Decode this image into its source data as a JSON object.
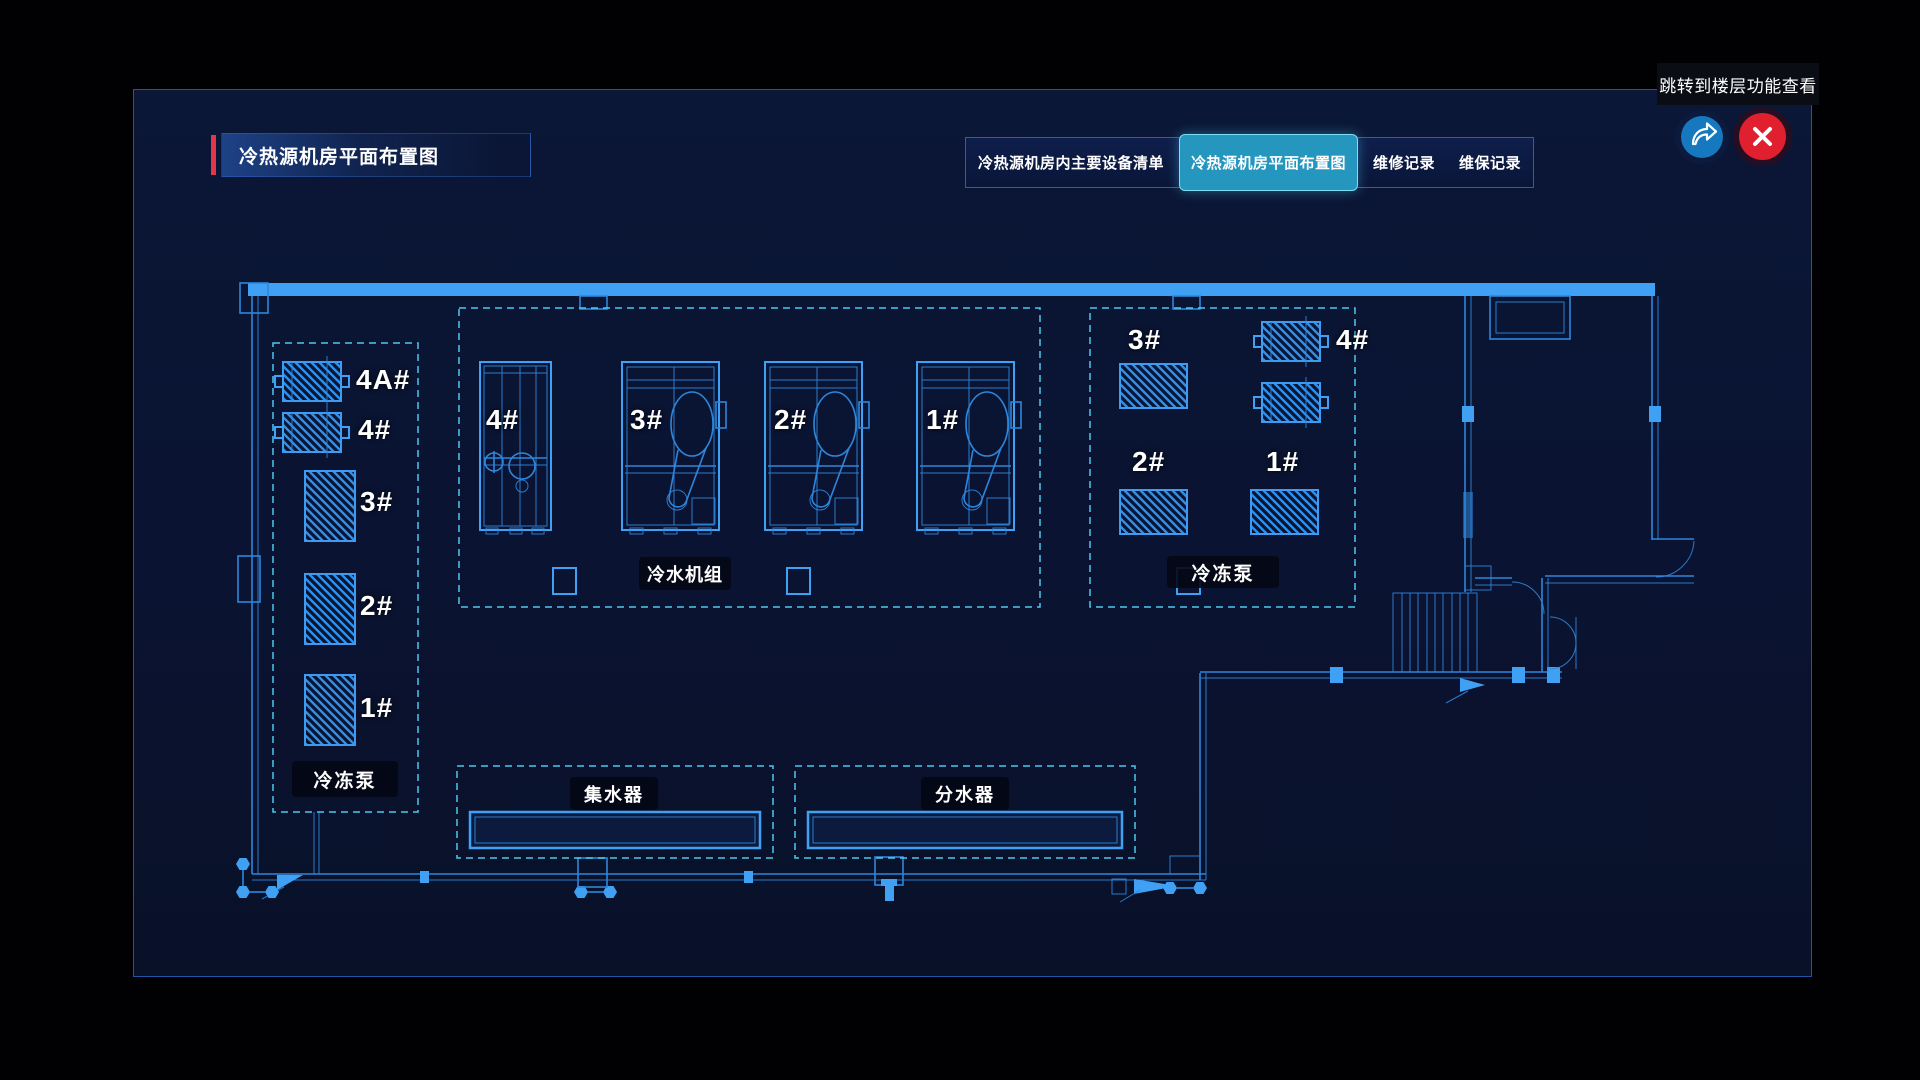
{
  "window": {
    "tooltip": "跳转到楼层功能查看",
    "title": "冷热源机房平面布置图"
  },
  "tabs": [
    {
      "label": "冷热源机房内主要设备清单",
      "active": false
    },
    {
      "label": "冷热源机房平面布置图",
      "active": true
    },
    {
      "label": "维修记录",
      "active": false
    },
    {
      "label": "维保记录",
      "active": false
    }
  ],
  "actions": {
    "share_icon": "share-forward-arrow",
    "close_icon": "close-x"
  },
  "floorplan": {
    "left_pumps": {
      "label": "冷冻泵",
      "units": [
        "4A#",
        "4#",
        "3#",
        "2#",
        "1#"
      ]
    },
    "chillers": {
      "label": "冷水机组",
      "units": [
        "4#",
        "3#",
        "2#",
        "1#"
      ]
    },
    "right_pumps": {
      "label": "冷冻泵",
      "units": [
        "3#",
        "4#",
        "2#",
        "1#"
      ]
    },
    "collector": {
      "label": "集水器"
    },
    "distributor": {
      "label": "分水器"
    }
  },
  "colors": {
    "accent_red": "#e4364b",
    "active_tab_teal": "#2596be",
    "wall_blue": "#3e9bf2",
    "cad_line_blue": "#2e86db",
    "dashed_cyan": "#4fc8ee",
    "close_red": "#e01f2f",
    "share_blue": "#1678bf",
    "panel_bg": "#0a1434",
    "panel_border": "#1e53a6"
  }
}
